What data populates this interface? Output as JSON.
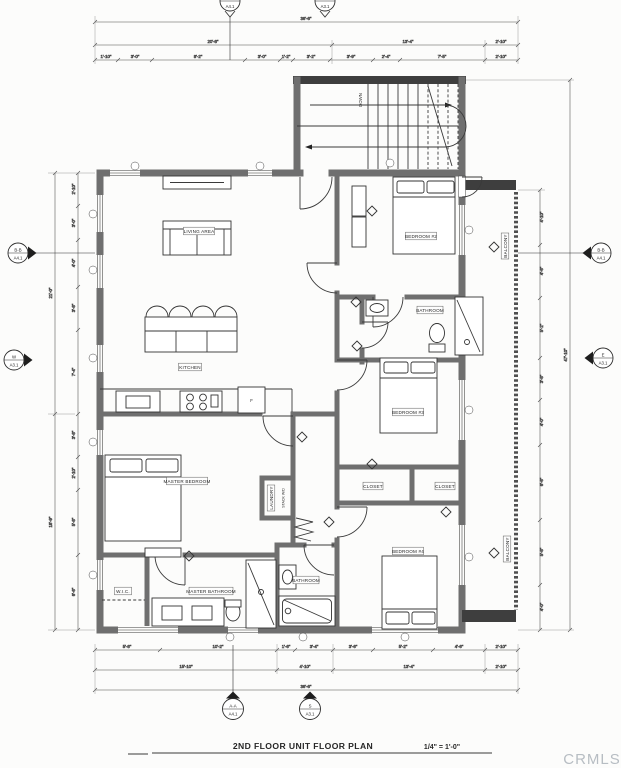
{
  "sheet": {
    "title": "2ND FLOOR UNIT FLOOR PLAN",
    "scale": "1/4\"  =  1'-0\"",
    "watermark": "CRMLS"
  },
  "rooms": {
    "living_area": "LIVING AREA",
    "kitchen": "KITCHEN",
    "master_bedroom": "MASTER BEDROOM",
    "bedroom_2": "BEDROOM #2",
    "bedroom_3": "BEDROOM #3",
    "bedroom_4": "BEDROOM #4",
    "bathroom_upper": "BATHROOM",
    "bathroom_lower": "BATHROOM",
    "master_bathroom": "MASTER BATHROOM",
    "closet_a": "CLOSET",
    "closet_b": "CLOSET",
    "wic": "W.I.C.",
    "laundry": "LAUNDRY",
    "stack_wd": "STACK W/D",
    "balcony_upper": "BALCONY",
    "balcony_lower": "BALCONY"
  },
  "annotations": {
    "down": "DOWN",
    "fridge": "F"
  },
  "markers": {
    "top_section": {
      "ref": "A4.1"
    },
    "top_elevation": {
      "ref": "A3.1"
    },
    "left_section": {
      "id": "B-B",
      "ref": "A4.1"
    },
    "left_elevation": {
      "id": "W",
      "ref": "A3.1"
    },
    "right_section": {
      "id": "B-B",
      "ref": "A4.1"
    },
    "right_elevation": {
      "id": "E",
      "ref": "A3.1"
    },
    "bottom_section": {
      "id": "A-A",
      "ref": "A4.1"
    },
    "bottom_elevation": {
      "id": "S",
      "ref": "A3.1"
    }
  },
  "dimensions": {
    "top_overall": "36'-6\"",
    "top_mid": [
      "20'-8\"",
      "13'-4\"",
      "2'-10\""
    ],
    "top_segments": [
      "1'-10\"",
      "3'-0\"",
      "8'-2\"",
      "3'-0\"",
      "1'-2\"",
      "3'-2\"",
      "3'-9\"",
      "2'-4\"",
      "7'-5\"",
      "2'-10\""
    ],
    "bottom_segments": [
      "5'-8\"",
      "10'-2\"",
      "1'-6\"",
      "3'-4\"",
      "3'-6\"",
      "5'-2\"",
      "4'-6\"",
      "2'-10\""
    ],
    "bottom_mid": [
      "15'-10\"",
      "4'-10\"",
      "13'-4\"",
      "2'-10\""
    ],
    "bottom_overall": "36'-6\"",
    "left_segments": [
      "2'-10\"",
      "3'-0\"",
      "4'-0\"",
      "3'-8\"",
      "7'-4\"",
      "3'-8\"",
      "2'-10\"",
      "5'-8\"",
      "6'-6\""
    ],
    "left_mid": [
      "21'-0\"",
      "18'-9\""
    ],
    "right_segments": [
      "4'-10\"",
      "4'-6\"",
      "5'-2\"",
      "3'-8\"",
      "4'-0\"",
      "6'-6\"",
      "5'-8\"",
      "4'-0\""
    ],
    "right_overall": "47'-10\""
  }
}
